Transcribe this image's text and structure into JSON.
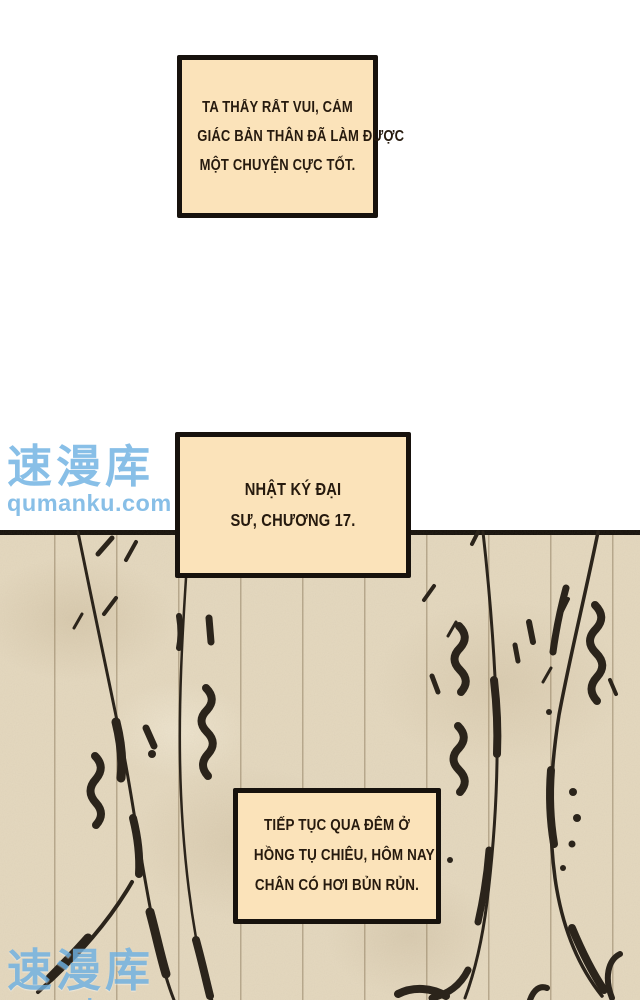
{
  "theme": {
    "page_bg": "#ffffff",
    "bubble_fill": "#fbe3ba",
    "bubble_border": "#17120d",
    "text_color": "#261a0e",
    "panel_bg": "#e5d9c0",
    "panel_line": "#b3a384",
    "ink": "#2b241b",
    "watermark_blue": "#6fb1e2"
  },
  "bubbles": [
    {
      "id": "narration-joy",
      "lines": [
        "TA THẤY RẤT VUI, CẢM",
        "GIÁC BẢN THÂN ĐÃ LÀM ĐƯỢC",
        "MỘT CHUYỆN CỰC TỐT."
      ]
    },
    {
      "id": "diary-title",
      "lines": [
        "NHẬT KÝ ĐẠI",
        "SƯ, CHƯƠNG 17."
      ]
    },
    {
      "id": "diary-entry",
      "lines": [
        "TIẾP TỤC QUA ĐÊM Ở",
        "HỒNG TỤ CHIÊU, HÔM NAY",
        "CHÂN CÓ HƠI BỦN RỦN."
      ]
    }
  ],
  "watermark": {
    "cjk": "速漫库",
    "url": "qumanku.com"
  }
}
